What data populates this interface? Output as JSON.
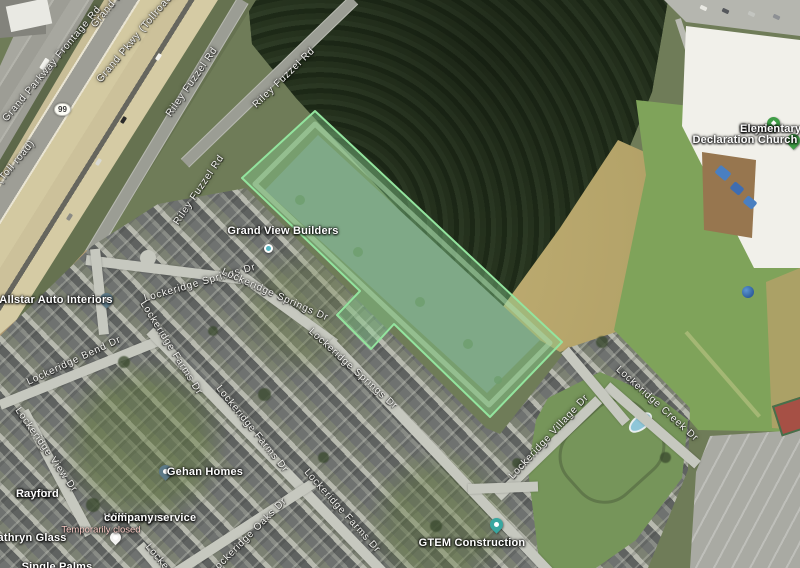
{
  "map_type": "satellite",
  "route_shield": {
    "number": "99"
  },
  "parcel": {
    "description": "highlighted lot outline over detention pond",
    "fill": "#82CD8C",
    "stroke": "#93E49E"
  },
  "pois": {
    "grand_view_builders": {
      "name": "Grand View Builders"
    },
    "allstar_auto_interiors": {
      "name": "Allstar Auto Interiors"
    },
    "gehan_homes": {
      "name": "Gehan Homes"
    },
    "gtem_construction": {
      "name": "GTEM Construction"
    },
    "william_pro": {
      "name_line1": "William pro",
      "name_line2": "company service",
      "status": "Temporarily closed"
    },
    "kathryn_glass": {
      "name": "Kathryn Glass"
    },
    "childrens_rayford": {
      "name_line1": "dren's",
      "name_line2": "Rayford"
    },
    "snyder_elementary": {
      "name_line1": "Snyder",
      "name_line2": "Elementary School"
    },
    "declaration_church": {
      "name": "Declaration Church"
    },
    "clipped_bottom": {
      "name": "Single Palms"
    }
  },
  "streets": {
    "grand_parkway_frontage_rd": "Grand Parkway Frontage Rd",
    "grand_parkway_frontage_partial": "Grand P",
    "grand_pkwy_tollroad": "Grand Pkwy (Tollroad)",
    "toll_road_suffix": "(Toll road)",
    "riley_fuzzel_rd": "Riley Fuzzel Rd",
    "lockeridge_springs_dr": "Lockeridge Springs Dr",
    "lockeridge_bend_dr": "Lockeridge Bend Dr",
    "lockeridge_view_dr": "Lockeridge View Dr",
    "lockeridge_farms_dr": "Lockeridge Farms Dr",
    "lockeridge_oaks_dr": "Lockeridge Oaks Dr",
    "lockeridge_village_dr": "Lockeridge Village Dr",
    "lockeridge_creek_dr": "Lockeridge Creek Dr",
    "locke_partial": "Locke"
  },
  "colors": {
    "parcel_fill": "#82CD8C",
    "parcel_stroke": "#93E49E",
    "pin_business": "#5d7a88",
    "pin_construction": "#39a7a0",
    "pin_place_green": "#3f9d46",
    "status_closed": "#f6c8c2"
  }
}
